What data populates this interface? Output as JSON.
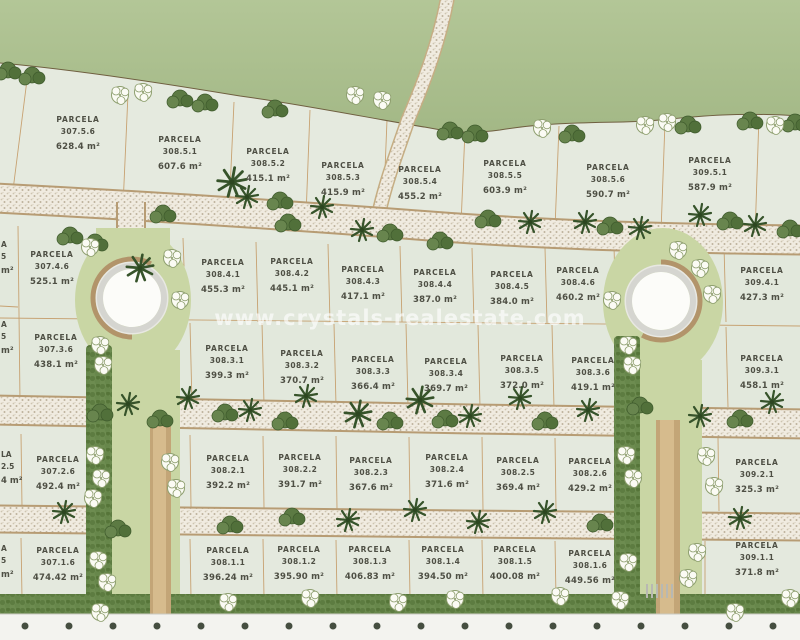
{
  "site": {
    "watermark": "www.crystals-realestate.com",
    "parcela_label": "PARCELA"
  },
  "colors": {
    "hill_green": "#aabe8d",
    "parcel_fill": "#e2e8dc",
    "boundary_tan": "#c49a66",
    "road_fill": "#f0ebe0",
    "landscape_green": "#c9d6a4",
    "hedge_green": "#6d8c50",
    "tree_dark_green": "#57743f",
    "watermark_white": "rgba(255,255,255,0.62)",
    "label_text": "#4e4f44"
  },
  "parcels": [
    {
      "id": "307.5.6",
      "area": "628.4 m²",
      "x": 78,
      "y": 115
    },
    {
      "id": "308.5.1",
      "area": "607.6 m²",
      "x": 180,
      "y": 135
    },
    {
      "id": "308.5.2",
      "area": "415.1 m²",
      "x": 268,
      "y": 147
    },
    {
      "id": "308.5.3",
      "area": "415.9 m²",
      "x": 343,
      "y": 161
    },
    {
      "id": "308.5.4",
      "area": "455.2 m²",
      "x": 420,
      "y": 165
    },
    {
      "id": "308.5.5",
      "area": "603.9 m²",
      "x": 505,
      "y": 159
    },
    {
      "id": "308.5.6",
      "area": "590.7 m²",
      "x": 608,
      "y": 163
    },
    {
      "id": "309.5.1",
      "area": "587.9 m²",
      "x": 710,
      "y": 156
    },
    {
      "id": "307.4.6",
      "area": "525.1 m²",
      "x": 52,
      "y": 250
    },
    {
      "id": "308.4.1",
      "area": "455.3 m²",
      "x": 223,
      "y": 258
    },
    {
      "id": "308.4.2",
      "area": "445.1 m²",
      "x": 292,
      "y": 257
    },
    {
      "id": "308.4.3",
      "area": "417.1 m²",
      "x": 363,
      "y": 265
    },
    {
      "id": "308.4.4",
      "area": "387.0 m²",
      "x": 435,
      "y": 268
    },
    {
      "id": "308.4.5",
      "area": "384.0 m²",
      "x": 512,
      "y": 270
    },
    {
      "id": "308.4.6",
      "area": "460.2 m²",
      "x": 578,
      "y": 266
    },
    {
      "id": "309.4.1",
      "area": "427.3 m²",
      "x": 762,
      "y": 266
    },
    {
      "id": "307.3.6",
      "area": "438.1 m²",
      "x": 56,
      "y": 333
    },
    {
      "id": "308.3.1",
      "area": "399.3 m²",
      "x": 227,
      "y": 344
    },
    {
      "id": "308.3.2",
      "area": "370.7 m²",
      "x": 302,
      "y": 349
    },
    {
      "id": "308.3.3",
      "area": "366.4 m²",
      "x": 373,
      "y": 355
    },
    {
      "id": "308.3.4",
      "area": "369.7 m²",
      "x": 446,
      "y": 357
    },
    {
      "id": "308.3.5",
      "area": "372.0 m²",
      "x": 522,
      "y": 354
    },
    {
      "id": "308.3.6",
      "area": "419.1 m²",
      "x": 593,
      "y": 356
    },
    {
      "id": "309.3.1",
      "area": "458.1 m²",
      "x": 762,
      "y": 354
    },
    {
      "id": "307.2.6",
      "area": "492.4 m²",
      "x": 58,
      "y": 455
    },
    {
      "id": "308.2.1",
      "area": "392.2 m²",
      "x": 228,
      "y": 454
    },
    {
      "id": "308.2.2",
      "area": "391.7 m²",
      "x": 300,
      "y": 453
    },
    {
      "id": "308.2.3",
      "area": "367.6 m²",
      "x": 371,
      "y": 456
    },
    {
      "id": "308.2.4",
      "area": "371.6 m²",
      "x": 447,
      "y": 453
    },
    {
      "id": "308.2.5",
      "area": "369.4 m²",
      "x": 518,
      "y": 456
    },
    {
      "id": "308.2.6",
      "area": "429.2 m²",
      "x": 590,
      "y": 457
    },
    {
      "id": "309.2.1",
      "area": "325.3 m²",
      "x": 757,
      "y": 458
    },
    {
      "id": "307.1.6",
      "area": "474.42 m²",
      "x": 58,
      "y": 546
    },
    {
      "id": "308.1.1",
      "area": "396.24 m²",
      "x": 228,
      "y": 546
    },
    {
      "id": "308.1.2",
      "area": "395.90 m²",
      "x": 299,
      "y": 545
    },
    {
      "id": "308.1.3",
      "area": "406.83 m²",
      "x": 370,
      "y": 545
    },
    {
      "id": "308.1.4",
      "area": "394.50 m²",
      "x": 443,
      "y": 545
    },
    {
      "id": "308.1.5",
      "area": "400.08 m²",
      "x": 515,
      "y": 545
    },
    {
      "id": "308.1.6",
      "area": "449.56 m²",
      "x": 590,
      "y": 549
    },
    {
      "id": "309.1.1",
      "area": "371.8 m²",
      "x": 757,
      "y": 541
    }
  ],
  "edge_fragments": [
    {
      "lines": [
        "A",
        "5",
        "m²"
      ],
      "y": 240
    },
    {
      "lines": [
        "A",
        "5",
        "m²"
      ],
      "y": 320
    },
    {
      "lines": [
        "LA",
        "2.5",
        "4 m²"
      ],
      "y": 450
    },
    {
      "lines": [
        "A",
        "5",
        "m²"
      ],
      "y": 544
    }
  ]
}
